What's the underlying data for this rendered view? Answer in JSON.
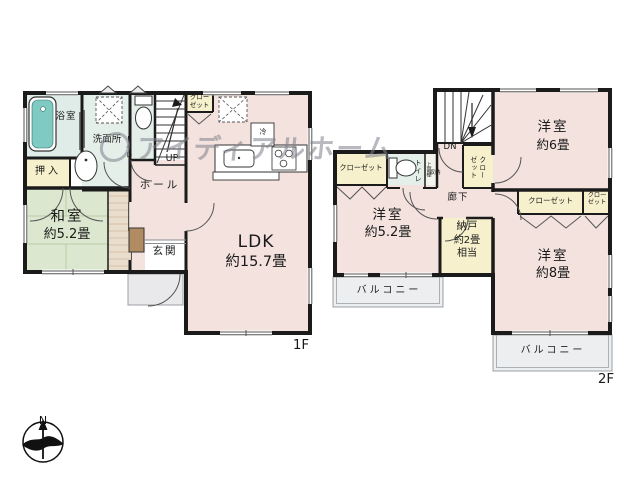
{
  "watermark": {
    "text": "アイディアルホーム"
  },
  "compass": {
    "north": "N"
  },
  "f1": {
    "floor_label": "1F",
    "bath": "浴室",
    "washroom": "洗面所",
    "toilet": "トイレ",
    "oshiire": "押入",
    "washitsu_name": "和室",
    "washitsu_size": "約5.2畳",
    "hall": "ホール",
    "genkan": "玄関",
    "ldk_name": "LDK",
    "ldk_size": "約15.7畳",
    "closet_l1": "クロー",
    "closet_l2": "ゼット",
    "up": "UP",
    "fridge": "冷"
  },
  "f2": {
    "floor_label": "2F",
    "room6_name": "洋室",
    "room6_size": "約6畳",
    "room52_name": "洋室",
    "room52_size": "約5.2畳",
    "room8_name": "洋室",
    "room8_size": "約8畳",
    "nando_l1": "納戸",
    "nando_l2": "約2畳",
    "nando_l3": "相当",
    "closet_left": "クローゼット",
    "closet_big": "クローゼット",
    "closet_small_l1": "クロー",
    "closet_small_l2": "ゼット",
    "closet_vert_c1": "クロー",
    "closet_vert_c2": "ゼット",
    "toilet": "トイレ",
    "shelf": "上部棚",
    "storage": "収納",
    "corridor": "廊下",
    "dn": "DN",
    "balcony_left": "バルコニー",
    "balcony_right": "バルコニー"
  },
  "colors": {
    "wall": "#1b1b1b",
    "room_pink": "#f3e2dd",
    "tatami_green": "#dbe8cf",
    "closet_cream": "#f6f0cd",
    "wet_area_cyan": "#e4efe9",
    "bathroom_cyan": "#dfece8",
    "bathtub_teal": "#7fcbc3",
    "balcony_gray": "#eceef0",
    "wood_brown": "#b18c63",
    "watermark_gray": "#84868f"
  }
}
